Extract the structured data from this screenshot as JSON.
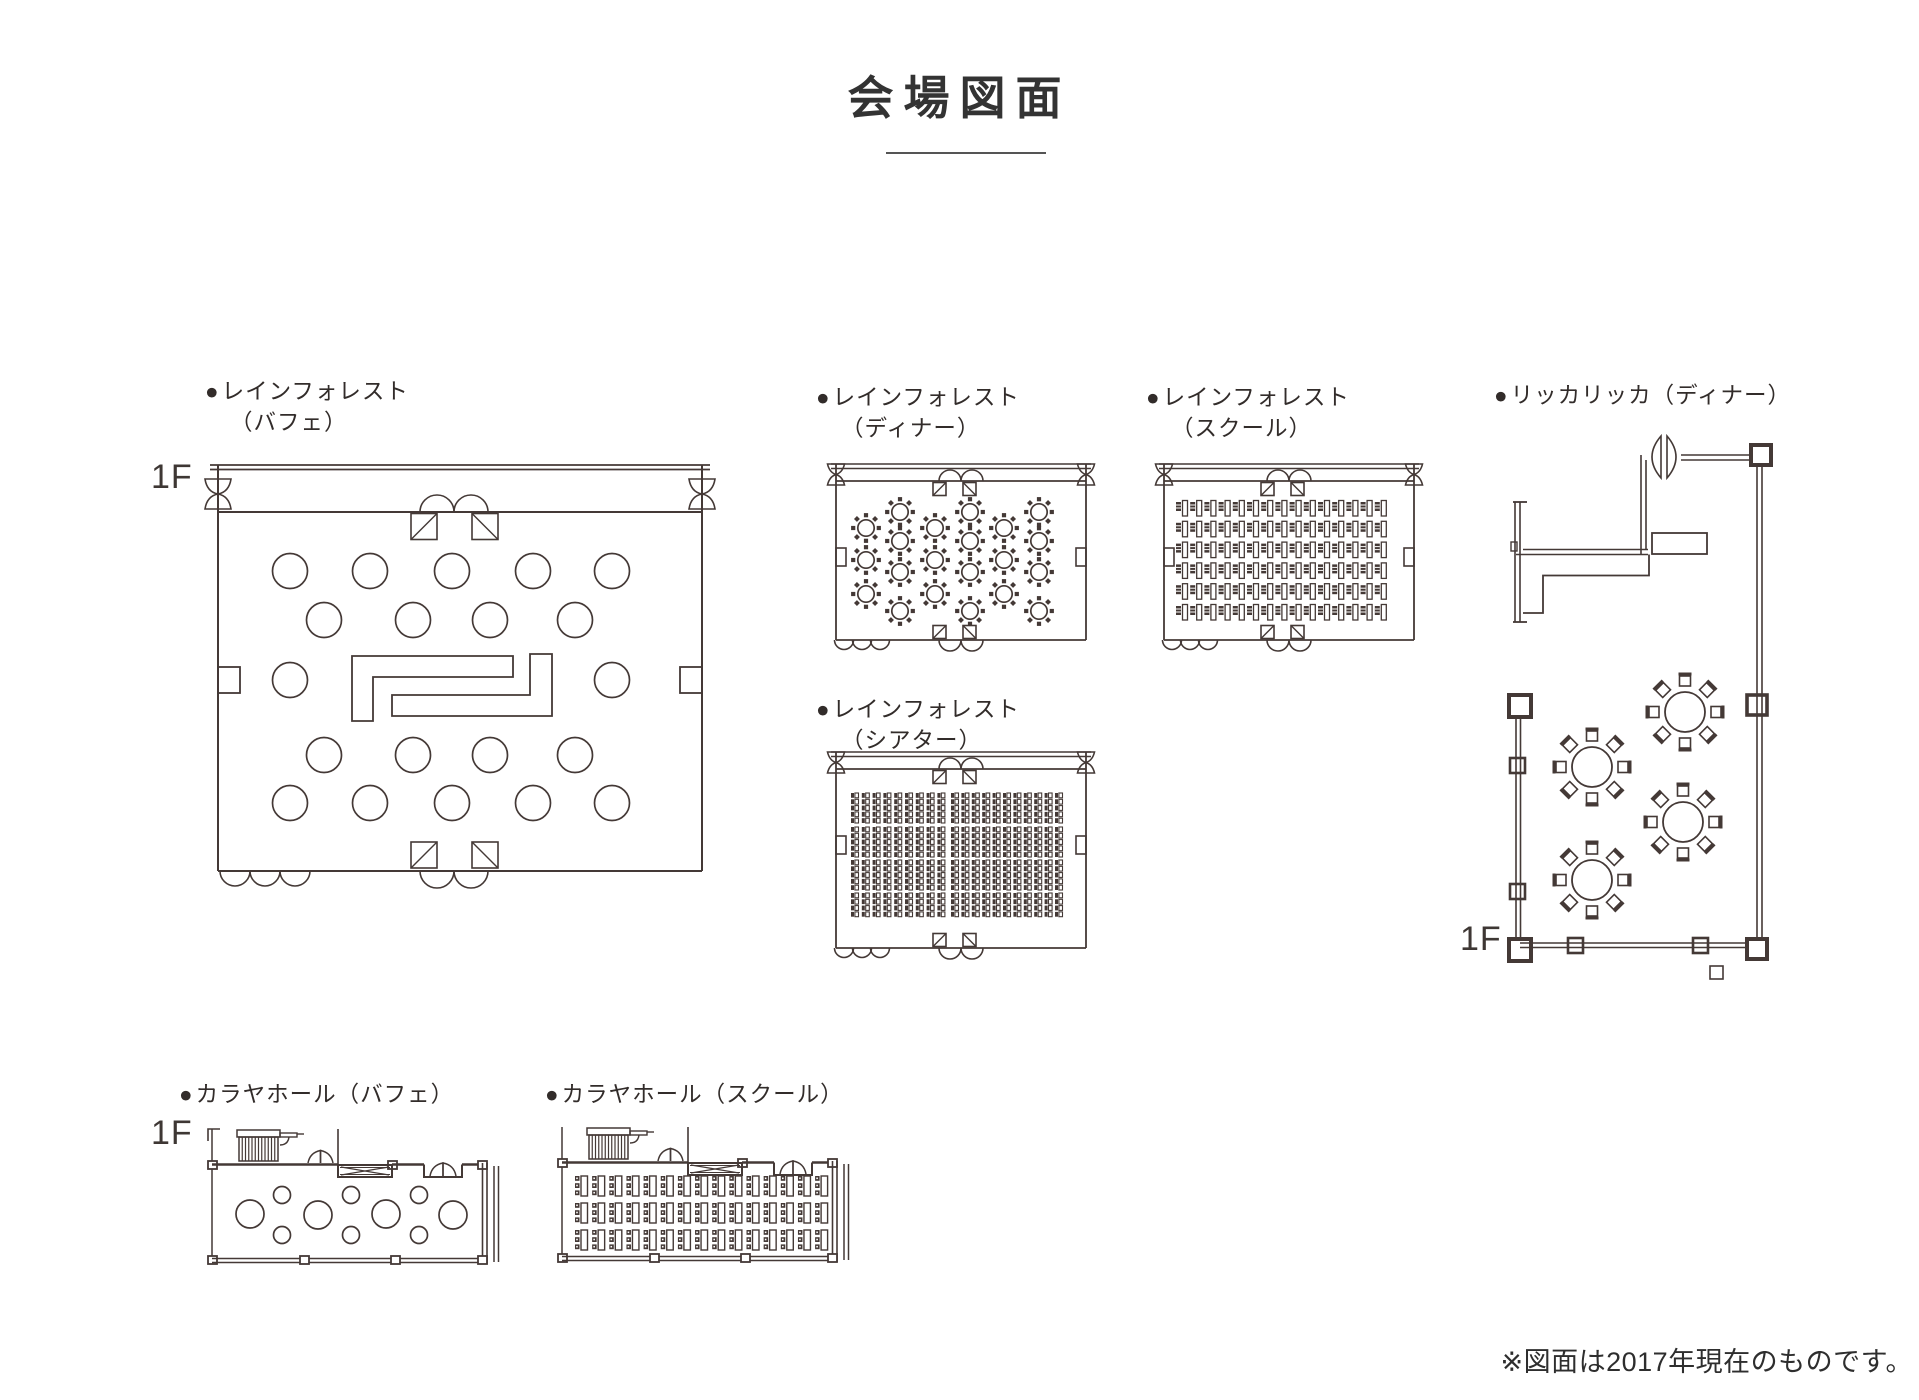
{
  "page": {
    "background": "#ffffff",
    "line_color": "#443936",
    "text_color": "#322c2a"
  },
  "title": {
    "text": "会場図面"
  },
  "footnote": {
    "text": "※図面は2017年現在のものです。"
  },
  "plans": [
    {
      "id": "rainforest-buffet",
      "bullet": "●",
      "name": "レインフォレスト",
      "variant": "（バフェ）",
      "floor": "1F",
      "furniture": {
        "round_tables_rows": [
          5,
          4,
          2,
          4,
          5
        ],
        "buffet_counter": true
      }
    },
    {
      "id": "rainforest-dinner",
      "bullet": "●",
      "name": "レインフォレスト",
      "variant": "（ディナー）",
      "furniture": {
        "table_columns": [
          3,
          4,
          3,
          4,
          3,
          4
        ],
        "chairs_per_table": 8
      }
    },
    {
      "id": "rainforest-school",
      "bullet": "●",
      "name": "レインフォレスト",
      "variant": "（スクール）",
      "furniture": {
        "desk_rows": 6,
        "desk_columns": 15
      }
    },
    {
      "id": "ricca-ricca-dinner",
      "bullet": "●",
      "name": "リッカリッカ（ディナー）",
      "variant": "",
      "floor": "1F",
      "furniture": {
        "round_tables": 4,
        "chairs_per_table": 8
      }
    },
    {
      "id": "rainforest-theater",
      "bullet": "●",
      "name": "レインフォレスト",
      "variant": "（シアター）",
      "furniture": {
        "seat_columns_left": 9,
        "seat_columns_right": 11,
        "seat_row_groups": [
          5,
          5,
          5,
          4
        ]
      }
    },
    {
      "id": "karaya-buffet",
      "bullet": "●",
      "name": "カラヤホール（バフェ）",
      "variant": "",
      "floor": "1F",
      "furniture": {
        "large_circles": 4,
        "small_circles": 6
      }
    },
    {
      "id": "karaya-school",
      "bullet": "●",
      "name": "カラヤホール（スクール）",
      "variant": "",
      "furniture": {
        "desk_rows": 3,
        "desk_columns": 15
      }
    }
  ]
}
